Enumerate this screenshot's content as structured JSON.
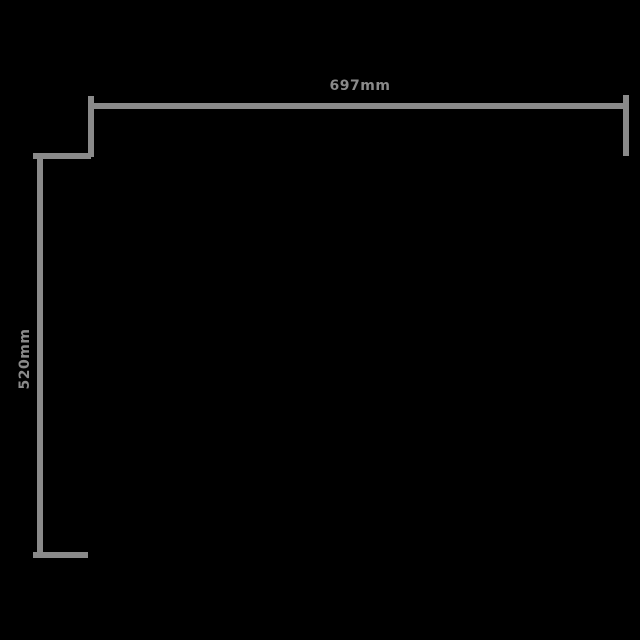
{
  "colors": {
    "bg": "#000000",
    "line": "#8a8a8a"
  },
  "diagram": {
    "type": "product-dimension-drawing",
    "width_label": "697mm",
    "height_label": "520mm"
  }
}
